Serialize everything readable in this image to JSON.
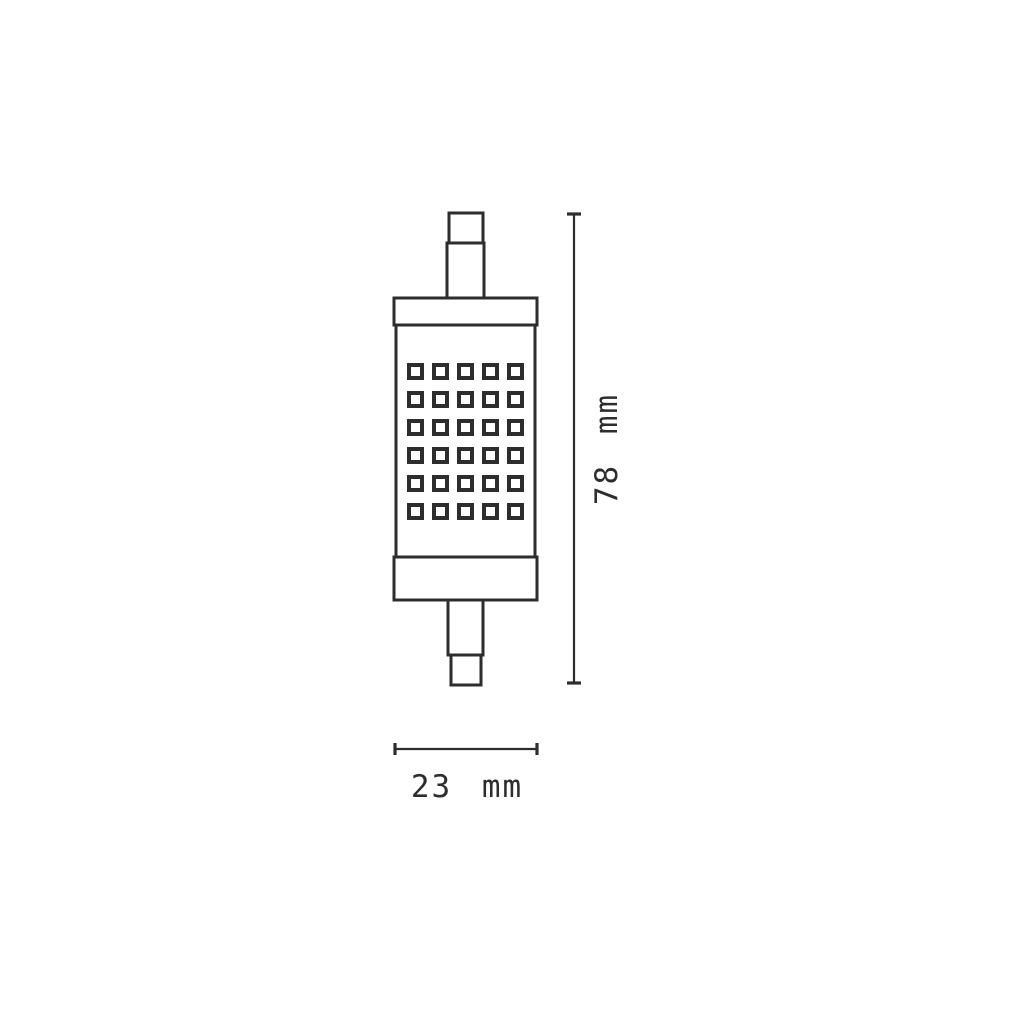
{
  "drawing": {
    "object_name": "r7s-led-lamp",
    "dimensions": {
      "height_label": "78 mm",
      "width_label": "23 mm"
    },
    "led_grid": {
      "rows": 6,
      "columns": 5
    },
    "colors": {
      "stroke": "#2d2d2d",
      "background": "#ffffff"
    }
  }
}
